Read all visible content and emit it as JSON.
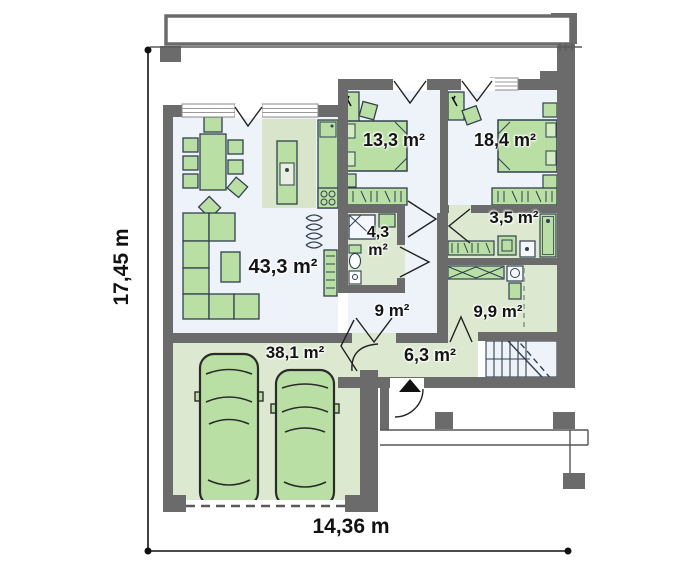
{
  "floor_plan": {
    "dimensions": {
      "width": "14,36 m",
      "height": "17,45 m"
    },
    "rooms": [
      {
        "name": "living-room",
        "area": "43,3 m²"
      },
      {
        "name": "garage",
        "area": "38,1 m²"
      },
      {
        "name": "bedroom-1",
        "area": "13,3 m²"
      },
      {
        "name": "bedroom-2",
        "area": "18,4 m²"
      },
      {
        "name": "bathroom-1",
        "area": "4,3 m²"
      },
      {
        "name": "bathroom-2",
        "area": "3,5 m²"
      },
      {
        "name": "corridor",
        "area": "9 m²"
      },
      {
        "name": "hall",
        "area": "9,9 m²"
      },
      {
        "name": "vestibule",
        "area": "6,3 m²"
      }
    ],
    "colors": {
      "wall": "#6b6b6b",
      "room_floor": "#eef2f9",
      "green_floor": "#dce8d0",
      "furniture": "#b9dfa4",
      "outline": "#31404f",
      "text": "#141414"
    }
  }
}
